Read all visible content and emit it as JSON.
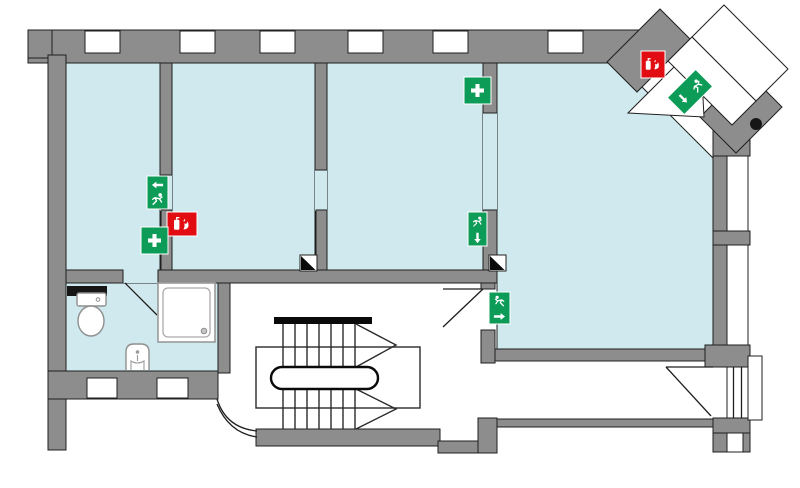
{
  "colors": {
    "background": "#ffffff",
    "wall": "#8d8d8d",
    "outline": "#1f1f1f",
    "room": "#cfe9ee",
    "safety_green": "#0d9b58",
    "safety_red": "#e20d13",
    "fixture_dark": "#161616"
  },
  "plan": {
    "kind": "evacuation-floor-plan",
    "rooms": [
      {
        "id": "room-1"
      },
      {
        "id": "room-2"
      },
      {
        "id": "room-3"
      },
      {
        "id": "main-room"
      },
      {
        "id": "bathroom"
      },
      {
        "id": "stairwell"
      },
      {
        "id": "corridor"
      }
    ],
    "signs": [
      {
        "id": "exit-sign-room1",
        "type": "emergency-exit",
        "symbols": [
          "arrow-left",
          "running-person"
        ]
      },
      {
        "id": "fire-extinguisher-sign-room1",
        "type": "fire-extinguisher",
        "symbols": [
          "extinguisher",
          "flames"
        ]
      },
      {
        "id": "first-aid-sign-room1",
        "type": "first-aid",
        "symbols": [
          "white-cross"
        ]
      },
      {
        "id": "first-aid-sign-main-room",
        "type": "first-aid",
        "symbols": [
          "white-cross"
        ]
      },
      {
        "id": "exit-sign-hall",
        "type": "emergency-exit",
        "symbols": [
          "running-person",
          "arrow-down"
        ]
      },
      {
        "id": "exit-sign-corridor",
        "type": "emergency-exit",
        "symbols": [
          "running-person",
          "arrow-right"
        ]
      },
      {
        "id": "fire-extinguisher-sign-entrance",
        "type": "fire-extinguisher",
        "symbols": [
          "extinguisher",
          "flames"
        ]
      },
      {
        "id": "exit-sign-entrance",
        "type": "emergency-exit",
        "rotation_deg": -45,
        "symbols": [
          "arrow-down",
          "running-person"
        ]
      }
    ],
    "fixtures": [
      {
        "id": "toilet"
      },
      {
        "id": "shower"
      },
      {
        "id": "sink"
      },
      {
        "id": "staircase"
      },
      {
        "id": "curved-wall"
      },
      {
        "id": "level-marker-1"
      },
      {
        "id": "level-marker-2"
      },
      {
        "id": "door-knob-dot"
      }
    ],
    "doors": [
      {
        "id": "bathroom-door"
      },
      {
        "id": "corridor-door"
      },
      {
        "id": "right-exterior-door"
      },
      {
        "id": "main-entrance-diagonal"
      }
    ],
    "windows": {
      "top_wall": 6,
      "bathroom": 2,
      "right_wall": 3
    }
  }
}
